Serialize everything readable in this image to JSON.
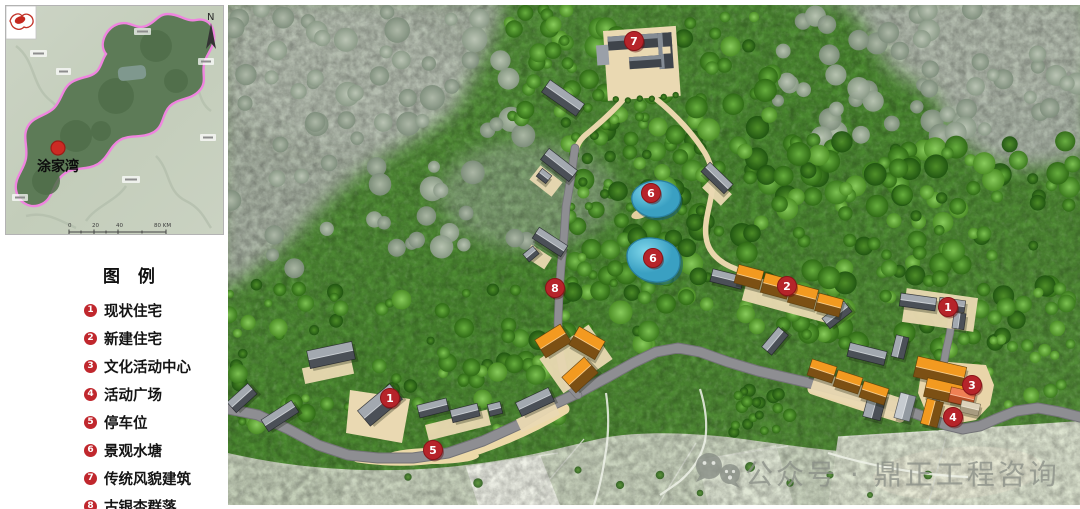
{
  "inset": {
    "place_label": "涂家湾",
    "north_label": "N",
    "scale_ticks": [
      "0",
      "20",
      "40",
      "80 KM"
    ]
  },
  "legend": {
    "title": "图 例",
    "marker_color": "#c0272d",
    "items": [
      {
        "num": "1",
        "label": "现状住宅"
      },
      {
        "num": "2",
        "label": "新建住宅"
      },
      {
        "num": "3",
        "label": "文化活动中心"
      },
      {
        "num": "4",
        "label": "活动广场"
      },
      {
        "num": "5",
        "label": "停车位"
      },
      {
        "num": "6",
        "label": "景观水塘"
      },
      {
        "num": "7",
        "label": "传统风貌建筑"
      },
      {
        "num": "8",
        "label": "古银杏群落"
      }
    ]
  },
  "map": {
    "marker_color": "#b6242a",
    "watermark": "公众号 · 鼎正工程咨询",
    "markers": [
      {
        "num": "7",
        "x": 406,
        "y": 36
      },
      {
        "num": "6",
        "x": 423,
        "y": 188
      },
      {
        "num": "6",
        "x": 425,
        "y": 253
      },
      {
        "num": "8",
        "x": 327,
        "y": 283
      },
      {
        "num": "2",
        "x": 559,
        "y": 281
      },
      {
        "num": "1",
        "x": 720,
        "y": 302
      },
      {
        "num": "3",
        "x": 744,
        "y": 380
      },
      {
        "num": "4",
        "x": 725,
        "y": 412
      },
      {
        "num": "1",
        "x": 162,
        "y": 393
      },
      {
        "num": "5",
        "x": 205,
        "y": 445
      }
    ]
  }
}
